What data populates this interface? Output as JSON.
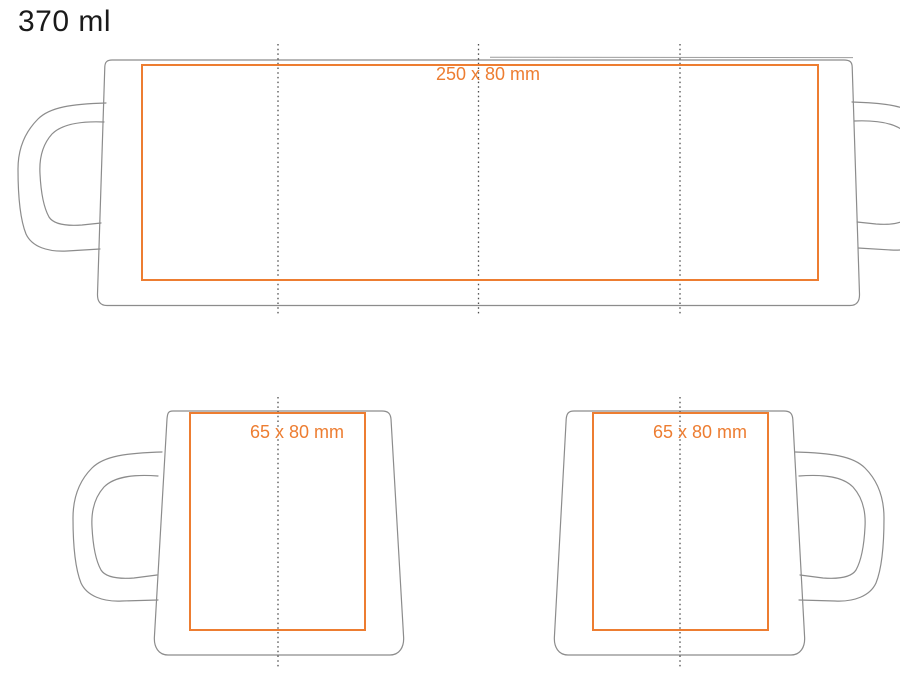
{
  "title": "370 ml",
  "labels": {
    "wrap_print_area": "250 x 80 mm",
    "left_mug_print_area": "65 x 80 mm",
    "right_mug_print_area": "65 x 80 mm"
  },
  "colors": {
    "print_area": "#ED7D31",
    "outline": "#8C8C8C",
    "centerline": "#4D4D4D",
    "title_color": "#1A1A1A"
  }
}
